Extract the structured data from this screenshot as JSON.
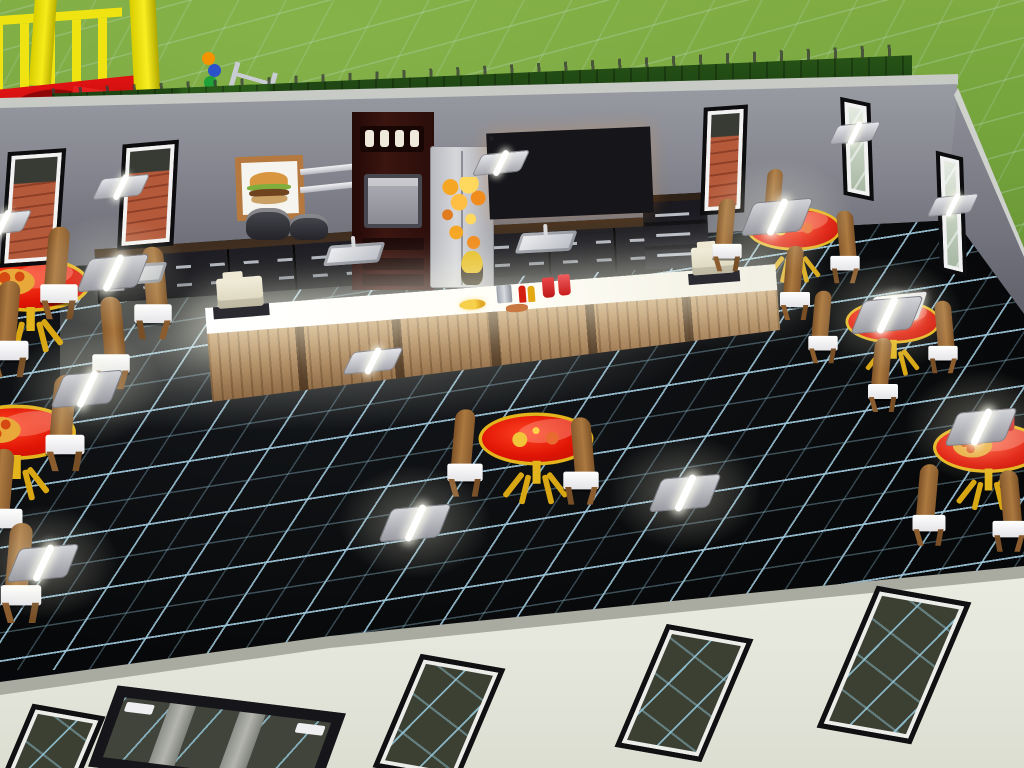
{
  "scene": {
    "type": "life-simulation game, top-down build view",
    "setting": "fast-food restaurant interior with outdoor playground and lawn",
    "visible_text": "none"
  },
  "palette": {
    "grass": "#74a33c",
    "hedge": "#1d4212",
    "wall_gray": "#85868f",
    "wall_cap": "#c8cac6",
    "front_wall_cream": "#e8eadf",
    "floor_black": "#07080b",
    "floor_grid_blue": "#9fc8da",
    "table_red": "#e01505",
    "table_trim_yellow": "#e3b41c",
    "chair_wood": "#9b6b3d",
    "seat_white": "#ffffff",
    "bar_wood": "#b4905f",
    "bar_top_glow": "#fffef6",
    "cabinet_black": "#131317",
    "cabinet_top_brown": "#3f2e1f",
    "oven_maroon": "#33120d",
    "fridge_steel": "#c9cacd",
    "menu_glow_orange": "#e8932a",
    "brick_patio": "#b4593a",
    "playground_yellow": "#efe412",
    "playground_red": "#d41515",
    "register_cream": "#e9e4cf"
  },
  "inventory": {
    "playground": [
      "yellow platform with railing",
      "red slide deck",
      "bead maze",
      "metal ladder"
    ],
    "kitchen": [
      "framed burger wall art",
      "wall pot rack",
      "two stock pots",
      "tall maroon oven tower with 4 knobs",
      "stainless refrigerator with fruit magnets",
      "lit snack display boards x4",
      "black counter runs with steel handles",
      "storage cabinet",
      "sinks x3"
    ],
    "bar": [
      "long wood bar with glowing white top",
      "cash register left",
      "cash register right",
      "fries plate",
      "napkin dispenser",
      "ketchup bottle",
      "mustard bottle",
      "red drink cups",
      "hot dog"
    ],
    "dining": [
      "red round pedestal tables x6",
      "wooden chairs with white seats x20"
    ],
    "lighting": [
      "ceiling tube lights x8",
      "wall sconce lights x6"
    ],
    "openings": [
      "tall wall windows x5",
      "front windows x4",
      "glass entry door x1"
    ]
  },
  "instances": {
    "tables": [
      {
        "x": -20,
        "y": 264,
        "scale": 1.2,
        "decal": "pizza"
      },
      {
        "x": -34,
        "y": 412,
        "scale": 1.2,
        "decal": "pizza"
      },
      {
        "x": 486,
        "y": 418,
        "scale": 1.15,
        "decal": "cond"
      },
      {
        "x": 744,
        "y": 205,
        "scale": 0.95,
        "decal": "cond"
      },
      {
        "x": 843,
        "y": 298,
        "scale": 0.95,
        "decal": "tray"
      },
      {
        "x": 938,
        "y": 426,
        "scale": 1.1,
        "decal": "pizza",
        "cup": true
      }
    ],
    "chairs": [
      {
        "x": 44,
        "y": 236,
        "scale": 1.25
      },
      {
        "x": 138,
        "y": 256,
        "scale": 1.25,
        "flip": true
      },
      {
        "x": -6,
        "y": 292,
        "scale": 1.3
      },
      {
        "x": 96,
        "y": 306,
        "scale": 1.25,
        "flip": true
      },
      {
        "x": 50,
        "y": 386,
        "scale": 1.3
      },
      {
        "x": -12,
        "y": 460,
        "scale": 1.3
      },
      {
        "x": 6,
        "y": 536,
        "scale": 1.35
      },
      {
        "x": 450,
        "y": 416,
        "scale": 1.18
      },
      {
        "x": 566,
        "y": 424,
        "scale": 1.18,
        "flip": true
      },
      {
        "x": 498,
        "y": 366,
        "scale": 1.12,
        "z": 4
      },
      {
        "x": 712,
        "y": 198,
        "scale": 0.98
      },
      {
        "x": 830,
        "y": 210,
        "scale": 0.98,
        "flip": true
      },
      {
        "x": 760,
        "y": 166,
        "scale": 0.92,
        "z": 4
      },
      {
        "x": 780,
        "y": 246,
        "scale": 1.0
      },
      {
        "x": 808,
        "y": 290,
        "scale": 0.98
      },
      {
        "x": 928,
        "y": 300,
        "scale": 0.98,
        "flip": true
      },
      {
        "x": 852,
        "y": 258,
        "scale": 0.92,
        "z": 4
      },
      {
        "x": 868,
        "y": 338,
        "scale": 1.0
      },
      {
        "x": 898,
        "y": 410,
        "scale": 1.05,
        "z": 4
      },
      {
        "x": 946,
        "y": 376,
        "scale": 1.0,
        "z": 4
      },
      {
        "x": 914,
        "y": 468,
        "scale": 1.1
      },
      {
        "x": 994,
        "y": 474,
        "scale": 1.1,
        "flip": true
      }
    ],
    "ceiling_lights": [
      {
        "x": 84,
        "y": 256
      },
      {
        "x": 58,
        "y": 372
      },
      {
        "x": 14,
        "y": 546
      },
      {
        "x": 386,
        "y": 506
      },
      {
        "x": 656,
        "y": 476
      },
      {
        "x": 748,
        "y": 200
      },
      {
        "x": 858,
        "y": 298
      },
      {
        "x": 952,
        "y": 410
      }
    ],
    "wall_sconces": [
      {
        "x": 98,
        "y": 176
      },
      {
        "x": -20,
        "y": 212
      },
      {
        "x": 478,
        "y": 152
      },
      {
        "x": 832,
        "y": 122,
        "scale": 0.9
      },
      {
        "x": 930,
        "y": 194,
        "scale": 0.9
      },
      {
        "x": 350,
        "y": 350,
        "scale": 1.05
      }
    ],
    "wall_windows": [
      {
        "x": 4,
        "y": 150,
        "w": 58,
        "h": 116,
        "skewY": -8,
        "rot": 4,
        "glass": "brick"
      },
      {
        "x": 120,
        "y": 142,
        "w": 56,
        "h": 106,
        "skewY": -8,
        "rot": 3,
        "glass": "brick"
      },
      {
        "x": 702,
        "y": 106,
        "w": 44,
        "h": 108,
        "skewY": -6,
        "rot": 2,
        "glass": "brick"
      },
      {
        "x": 842,
        "y": 100,
        "w": 30,
        "h": 98,
        "skewY": 14,
        "rot": -2,
        "glass": "pale"
      },
      {
        "x": 938,
        "y": 154,
        "w": 27,
        "h": 120,
        "skewY": 16,
        "rot": -2,
        "glass": "pale"
      }
    ],
    "sinks": [
      {
        "x": 108,
        "y": 258,
        "rot": -4
      },
      {
        "x": 326,
        "y": 238,
        "rot": -4
      },
      {
        "x": 518,
        "y": 226,
        "rot": -3
      }
    ],
    "front_openings": [
      {
        "type": "window",
        "x": 16,
        "y": 708,
        "w": 74,
        "h": 80,
        "rot": 10
      },
      {
        "type": "door",
        "x": 102,
        "y": 698,
        "w": 230,
        "h": 84,
        "rot": 7
      },
      {
        "type": "window",
        "x": 396,
        "y": 658,
        "w": 86,
        "h": 120,
        "rot": 10
      },
      {
        "type": "window",
        "x": 640,
        "y": 628,
        "w": 88,
        "h": 130,
        "rot": 10
      },
      {
        "type": "window",
        "x": 846,
        "y": 590,
        "w": 96,
        "h": 150,
        "rot": 10
      }
    ]
  }
}
